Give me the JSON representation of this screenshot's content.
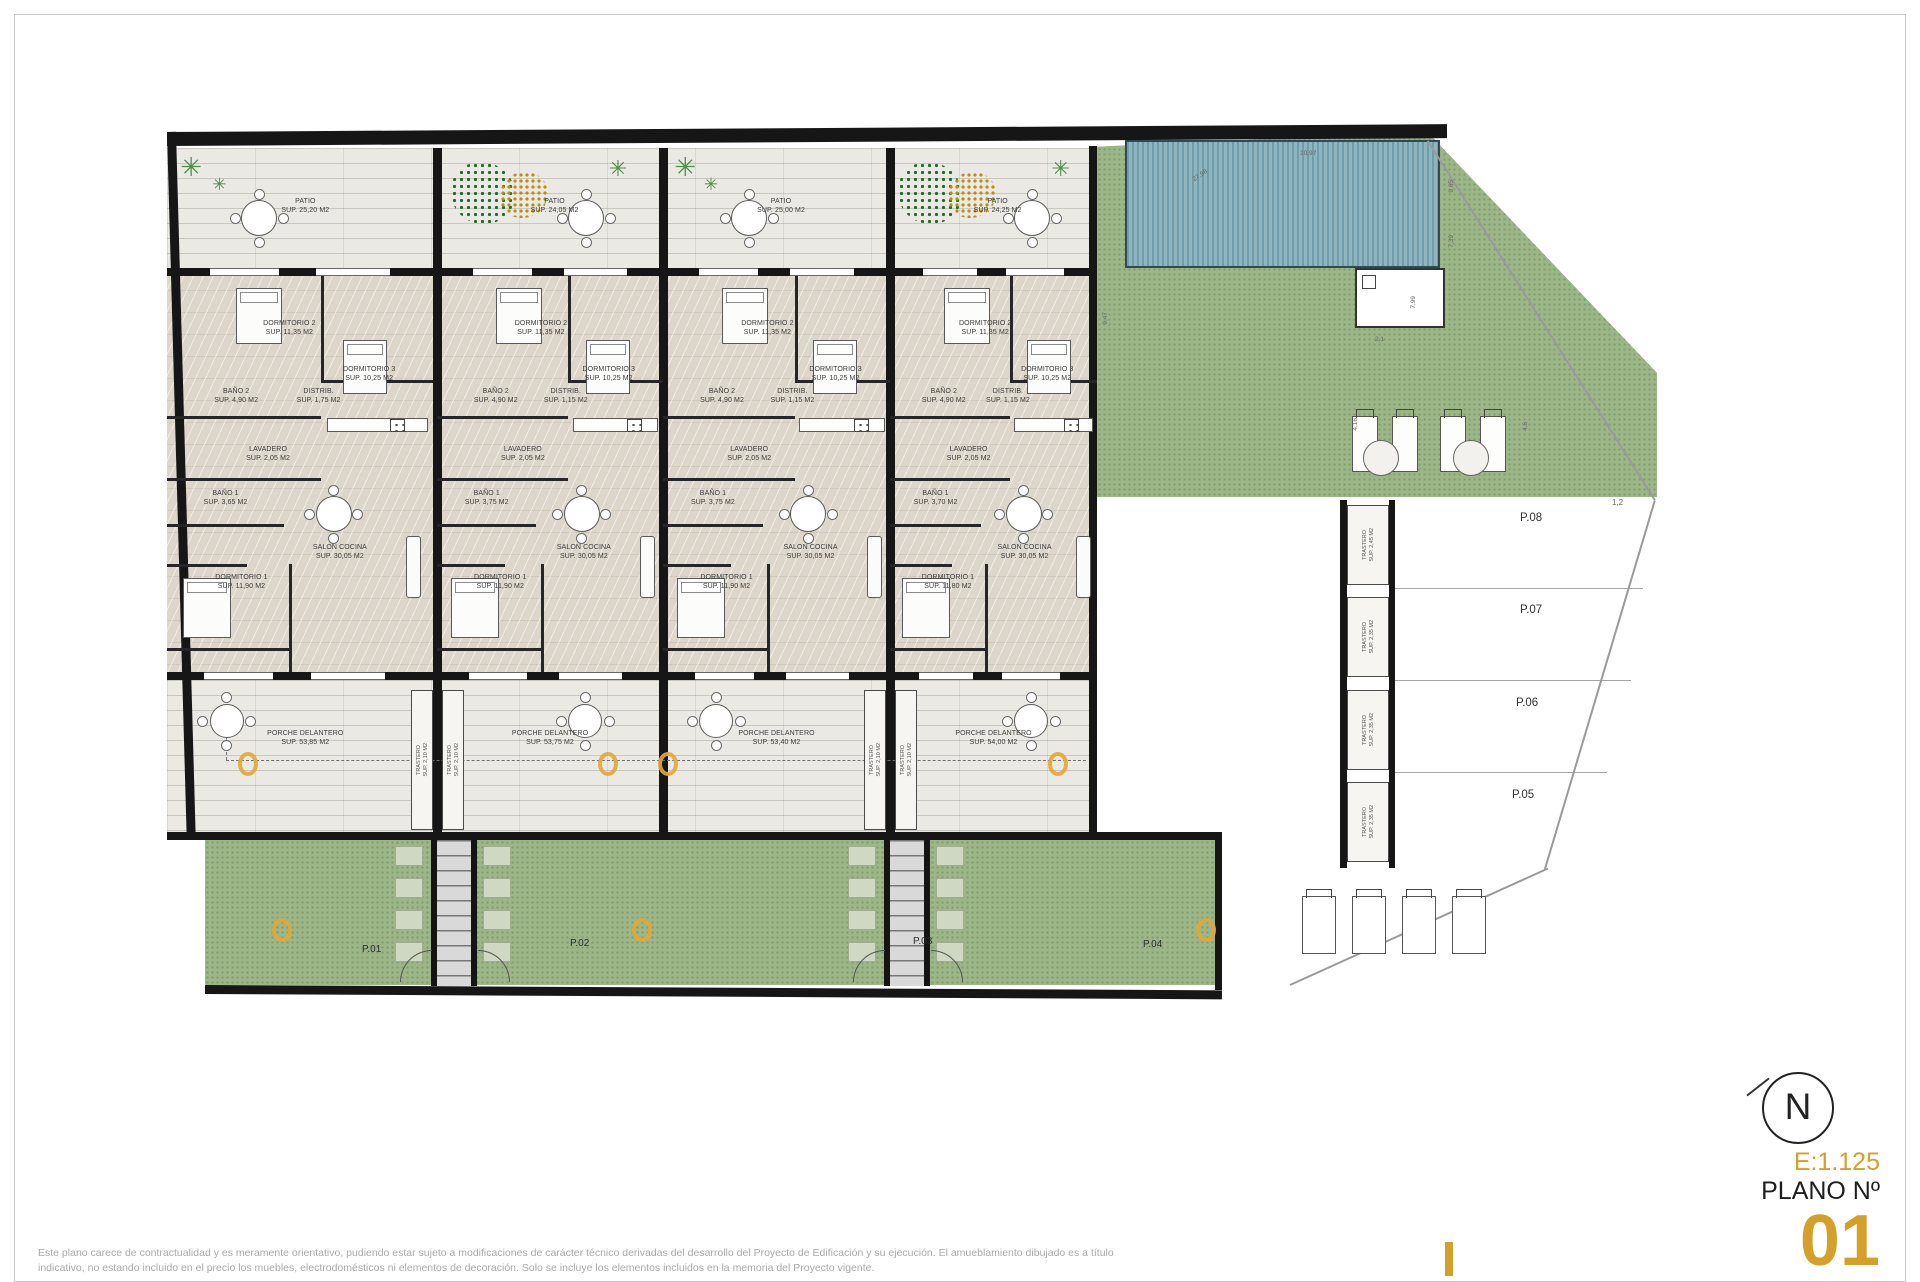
{
  "title_block": {
    "north": "N",
    "scale": "E:1.125",
    "plano_label": "PLANO Nº",
    "plano_number": "01"
  },
  "disclaimer": {
    "line1": "Este plano carece de contractualidad y es meramente orientativo, pudiendo estar sujeto a modificaciones de carácter técnico derivadas del desarrollo del Proyecto de Edificación y su ejecución. El amueblamiento dibujado es a título",
    "line2": "indicativo, no estando incluido en el precio los muebles, electrodomésticos ni elementos de decoración. Solo se incluye los elementos incluidos en la memoria del Proyecto vigente."
  },
  "units": [
    {
      "plot": "P.01",
      "patio_name": "PATIO",
      "patio_sup": "SUP. 25,20 M2",
      "dorm2_name": "DORMITORIO 2",
      "dorm2_sup": "SUP. 11,35 M2",
      "dorm3_name": "DORMITORIO 3",
      "dorm3_sup": "SUP. 10,25 M2",
      "bano2_name": "BAÑO 2",
      "bano2_sup": "SUP. 4,90 M2",
      "distrib_name": "DISTRIB.",
      "distrib_sup": "SUP. 1,75 M2",
      "lavadero_name": "LAVADERO",
      "lavadero_sup": "SUP. 2,05 M2",
      "bano1_name": "BAÑO 1",
      "bano1_sup": "SUP. 3,65 M2",
      "salon_name": "SALON COCINA",
      "salon_sup": "SUP. 30,05 M2",
      "dorm1_name": "DORMITORIO 1",
      "dorm1_sup": "SUP. 11,90 M2",
      "porche_name": "PORCHE DELANTERO",
      "porche_sup": "SUP. 53,85 M2"
    },
    {
      "plot": "P.02",
      "patio_name": "PATIO",
      "patio_sup": "SUP. 24,05 M2",
      "dorm2_name": "DORMITORIO 2",
      "dorm2_sup": "SUP. 11,35 M2",
      "dorm3_name": "DORMITORIO 3",
      "dorm3_sup": "SUP. 10,25 M2",
      "bano2_name": "BAÑO 2",
      "bano2_sup": "SUP. 4,90 M2",
      "distrib_name": "DISTRIB.",
      "distrib_sup": "SUP. 1,15 M2",
      "lavadero_name": "LAVADERO",
      "lavadero_sup": "SUP. 2,05 M2",
      "bano1_name": "BAÑO 1",
      "bano1_sup": "SUP. 3,75 M2",
      "salon_name": "SALON COCINA",
      "salon_sup": "SUP. 30,05 M2",
      "dorm1_name": "DORMITORIO 1",
      "dorm1_sup": "SUP. 11,90 M2",
      "porche_name": "PORCHE DELANTERO",
      "porche_sup": "SUP. 53,75 M2"
    },
    {
      "plot": "P.03",
      "patio_name": "PATIO",
      "patio_sup": "SUP. 25,00 M2",
      "dorm2_name": "DORMITORIO 2",
      "dorm2_sup": "SUP. 11,35 M2",
      "dorm3_name": "DORMITORIO 3",
      "dorm3_sup": "SUP. 10,25 M2",
      "bano2_name": "BAÑO 2",
      "bano2_sup": "SUP. 4,90 M2",
      "distrib_name": "DISTRIB.",
      "distrib_sup": "SUP. 1,15 M2",
      "lavadero_name": "LAVADERO",
      "lavadero_sup": "SUP. 2,05 M2",
      "bano1_name": "BAÑO 1",
      "bano1_sup": "SUP. 3,75 M2",
      "salon_name": "SALON COCINA",
      "salon_sup": "SUP. 30,05 M2",
      "dorm1_name": "DORMITORIO 1",
      "dorm1_sup": "SUP. 11,90 M2",
      "porche_name": "PORCHE DELANTERO",
      "porche_sup": "SUP. 53,40 M2"
    },
    {
      "plot": "P.04",
      "patio_name": "PATIO",
      "patio_sup": "SUP. 24,25 M2",
      "dorm2_name": "DORMITORIO 2",
      "dorm2_sup": "SUP. 11,35 M2",
      "dorm3_name": "DORMITORIO 3",
      "dorm3_sup": "SUP. 10,25 M2",
      "bano2_name": "BAÑO 2",
      "bano2_sup": "SUP. 4,90 M2",
      "distrib_name": "DISTRIB.",
      "distrib_sup": "SUP. 1,15 M2",
      "lavadero_name": "LAVADERO",
      "lavadero_sup": "SUP. 2,05 M2",
      "bano1_name": "BAÑO 1",
      "bano1_sup": "SUP. 3,70 M2",
      "salon_name": "SALON COCINA",
      "salon_sup": "SUP. 30,05 M2",
      "dorm1_name": "DORMITORIO 1",
      "dorm1_sup": "SUP. 11,80 M2",
      "porche_name": "PORCHE DELANTERO",
      "porche_sup": "SUP. 54,00 M2"
    }
  ],
  "shared": {
    "trastero_name": "TRASTERO",
    "trastero_sup": "SUP. 2,10 M2"
  },
  "right_zone": {
    "rows": [
      {
        "plot": "P.08",
        "trastero_name": "TRASTERO",
        "trastero_sup": "SUP. 2,45 M2"
      },
      {
        "plot": "P.07",
        "trastero_name": "TRASTERO",
        "trastero_sup": "SUP. 2,35 M2"
      },
      {
        "plot": "P.06",
        "trastero_name": "TRASTERO",
        "trastero_sup": "SUP. 2,35 M2"
      },
      {
        "plot": "P.05",
        "trastero_name": "TRASTERO",
        "trastero_sup": "SUP. 2,35 M2"
      }
    ],
    "dims": {
      "pool_top": "10,97",
      "pool_arc": "27,98",
      "pool_right_a": "9,65",
      "pool_right_b": "7,39",
      "pool_right_c": "7,99",
      "deck_left": "9,47",
      "deck_mid": "2,1",
      "deck_bottom_left": "4,16",
      "deck_bottom_right": "4,6",
      "parking_top": "1,2"
    }
  }
}
